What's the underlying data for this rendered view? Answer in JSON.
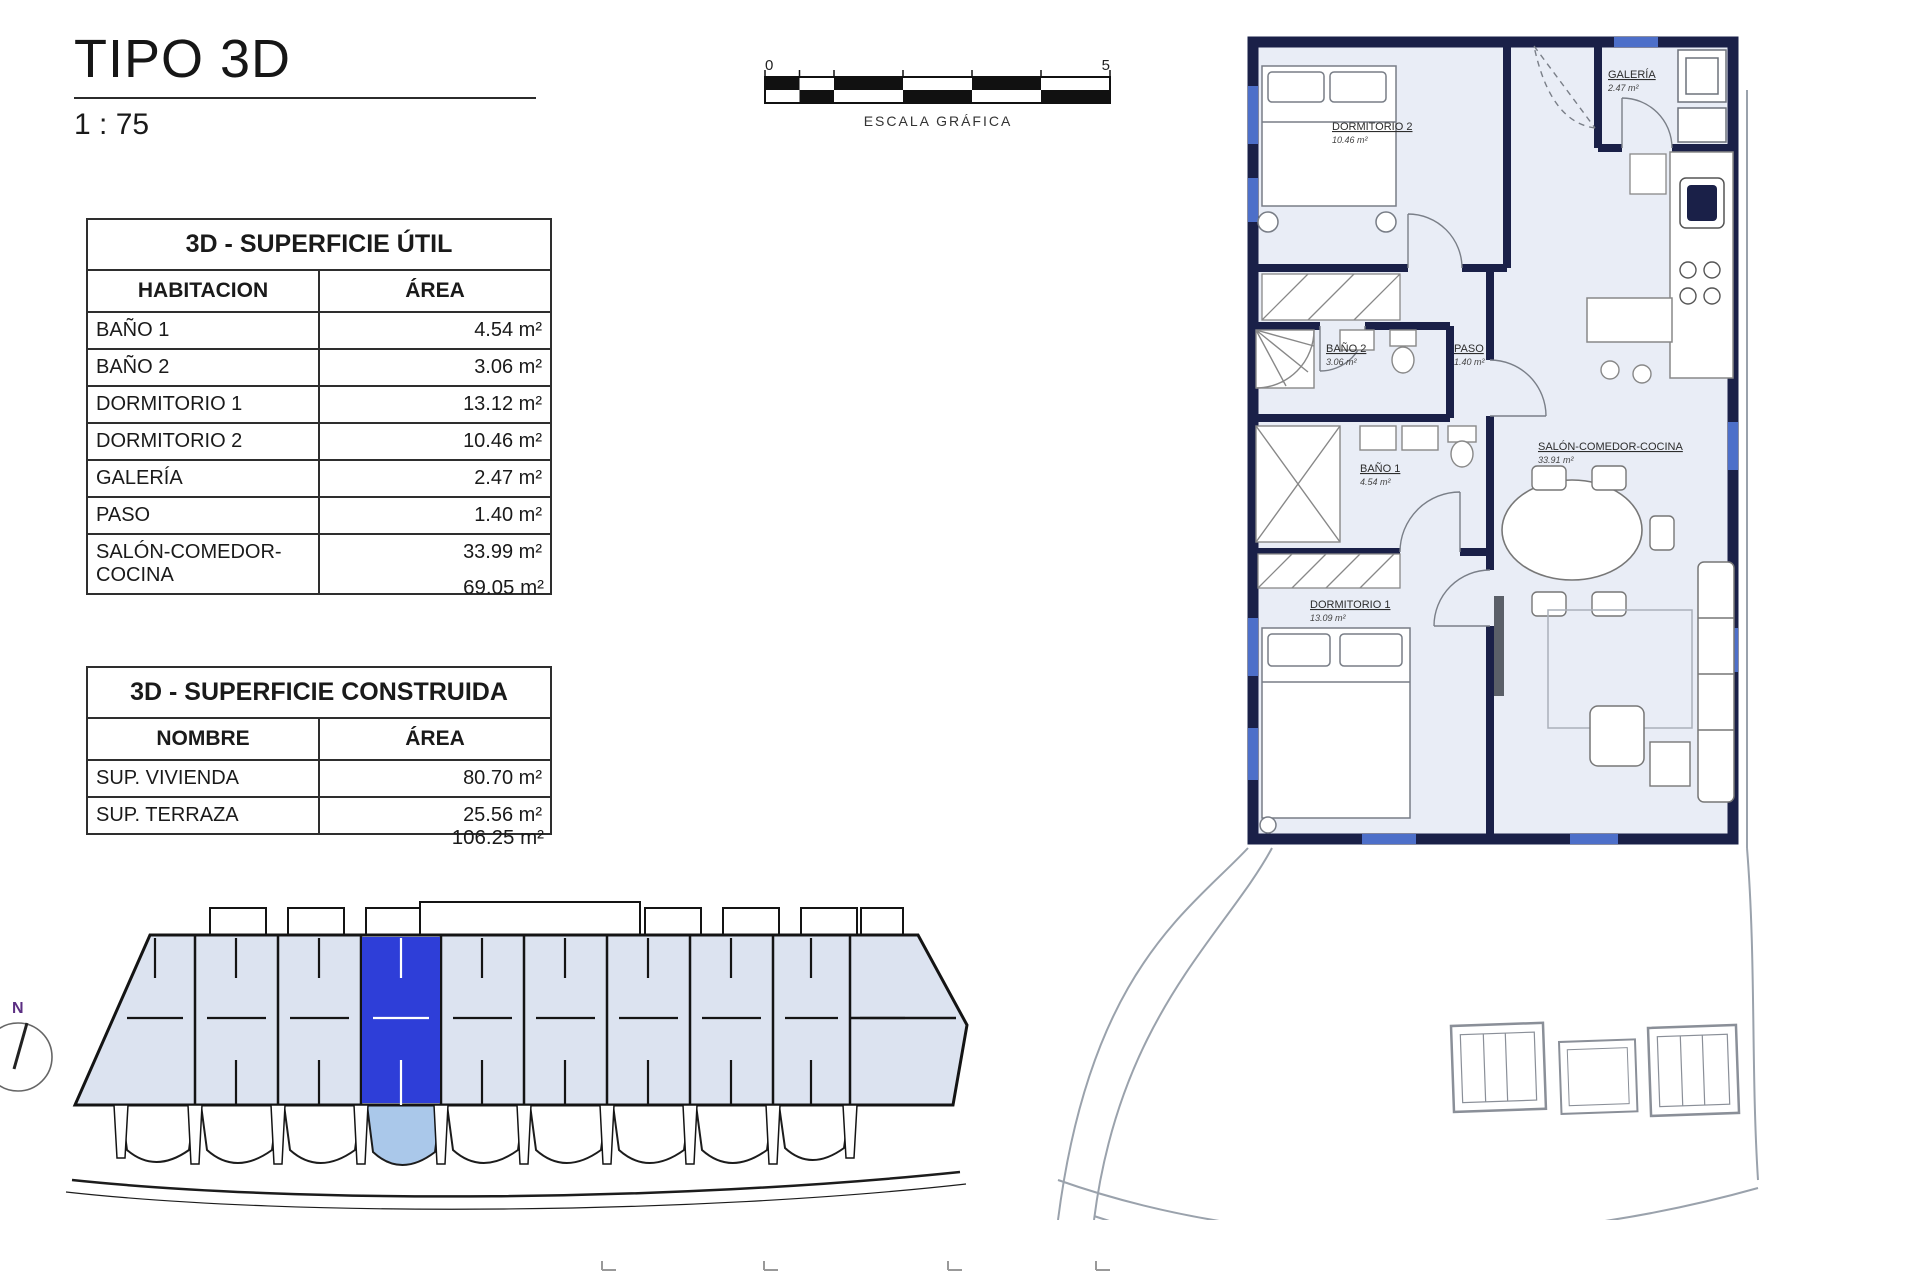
{
  "title": "TIPO 3D",
  "scale_ratio": "1 : 75",
  "scale_bar": {
    "tick_start": "0",
    "tick_end": "5",
    "label": "ESCALA GRÁFICA"
  },
  "north_label": "N",
  "tables": {
    "util": {
      "title": "3D - SUPERFICIE ÚTIL",
      "col_room": "HABITACION",
      "col_area": "ÁREA",
      "rows": [
        {
          "room": "BAÑO 1",
          "area": "4.54 m²"
        },
        {
          "room": "BAÑO 2",
          "area": "3.06 m²"
        },
        {
          "room": "DORMITORIO 1",
          "area": "13.12 m²"
        },
        {
          "room": "DORMITORIO 2",
          "area": "10.46 m²"
        },
        {
          "room": "GALERÍA",
          "area": "2.47 m²"
        },
        {
          "room": "PASO",
          "area": "1.40 m²"
        },
        {
          "room": "SALÓN-COMEDOR-COCINA",
          "area": "33.99 m²"
        }
      ],
      "total": "69.05 m²"
    },
    "construida": {
      "title": "3D - SUPERFICIE CONSTRUIDA",
      "col_name": "NOMBRE",
      "col_area": "ÁREA",
      "rows": [
        {
          "name": "SUP. VIVIENDA",
          "area": "80.70 m²"
        },
        {
          "name": "SUP. TERRAZA",
          "area": "25.56 m²"
        }
      ],
      "total": "106.25 m²"
    }
  },
  "plan_rooms": {
    "dormitorio2": {
      "name": "DORMITORIO 2",
      "area": "10.46 m²"
    },
    "galeria": {
      "name": "GALERÍA",
      "area": "2.47 m²"
    },
    "bano2": {
      "name": "BAÑO 2",
      "area": "3.06 m²"
    },
    "paso": {
      "name": "PASO",
      "area": "1.40 m²"
    },
    "bano1": {
      "name": "BAÑO 1",
      "area": "4.54 m²"
    },
    "salon": {
      "name": "SALÓN-COMEDOR-COCINA",
      "area": "33.91 m²"
    },
    "dormitorio1": {
      "name": "DORMITORIO 1",
      "area": "13.09 m²"
    }
  },
  "colors": {
    "wall_navy": "#1a2048",
    "floor": "#e9edf6",
    "unit_highlight": "#2e3ed8",
    "terrace_highlight": "#aac8ea",
    "keyplan_fill": "#dce3f0",
    "window_accent": "#4d6fc9",
    "north_n": "#5b2e82"
  }
}
